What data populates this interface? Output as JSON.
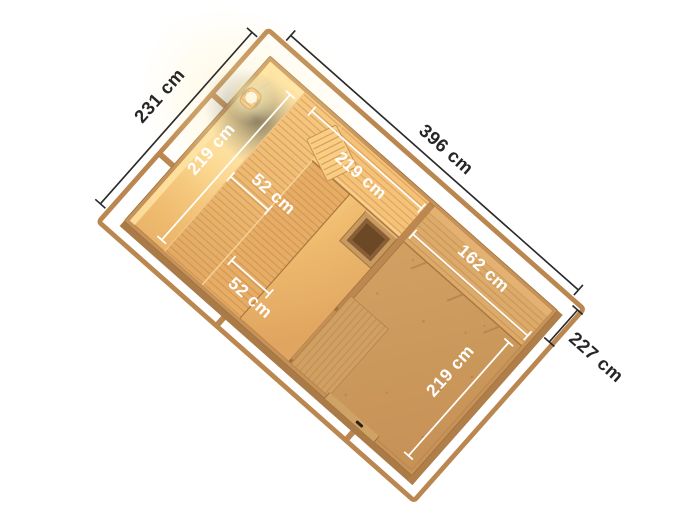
{
  "page": {
    "background": "#ffffff",
    "description": "3D aerial cutaway floor plan of a wooden sauna house with dimension annotations"
  },
  "diagram": {
    "kind": "sauna-floorplan-3d-render",
    "exterior_dimensions": {
      "left": "231 cm",
      "top": "396 cm",
      "right": "227 cm"
    },
    "sauna_room": {
      "width": "219 cm",
      "depth": "219 cm",
      "bench_depth_upper": "52 cm",
      "bench_depth_lower": "52 cm"
    },
    "anteroom": {
      "bench_length": "162 cm",
      "width": "219 cm"
    },
    "features": {
      "lamp": "sauna-wall-lamp",
      "heater": "sauna-heater",
      "headrest": "bench-headrest",
      "benches": "tiered-sauna-benches",
      "duckboard": "floor-duckboard",
      "door_handle": "entrance-door-handle"
    },
    "colors": {
      "frame_wood": "#bb8750",
      "wall_wood": "#c69257",
      "anteroom_floor": "#cc9c60",
      "sauna_glow": "#fbd58c",
      "bench_wood": "#eab26c",
      "dim_text_dark": "#262626",
      "dim_text_light": "#ffffff"
    }
  }
}
